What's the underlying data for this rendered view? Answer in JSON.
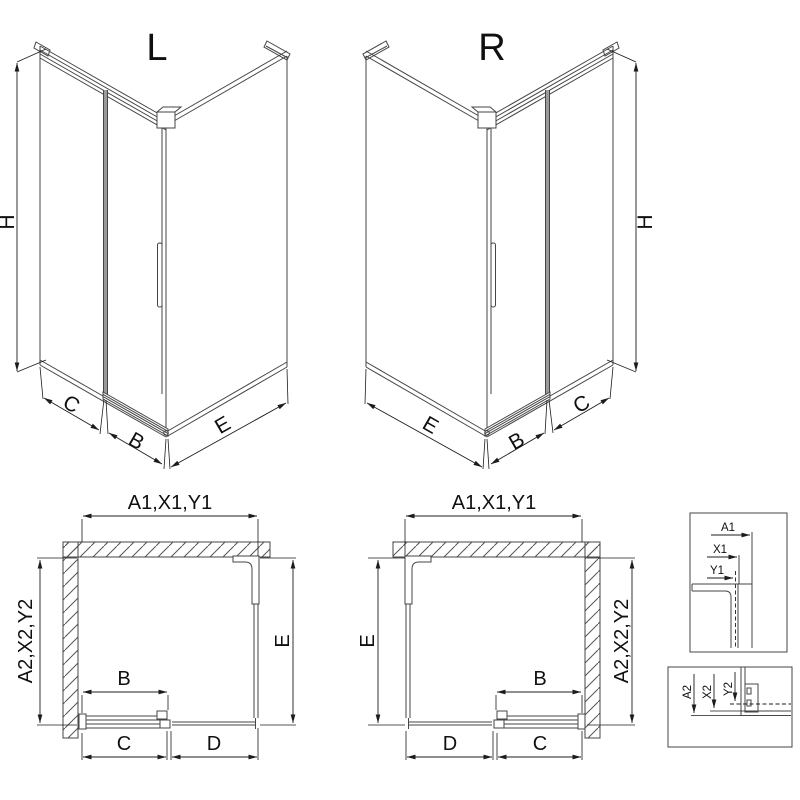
{
  "colors": {
    "line": "#454545",
    "dimension": "#1c1c1c",
    "text": "#101010",
    "door_seal": "#9a9a9a",
    "background": "#ffffff"
  },
  "iso_left": {
    "title": "L",
    "dims": {
      "height": "H",
      "fixed": "C",
      "door": "B",
      "side": "E"
    }
  },
  "iso_right": {
    "title": "R",
    "dims": {
      "height": "H",
      "side": "E",
      "door": "B",
      "fixed": "C"
    }
  },
  "plan_left": {
    "dims": {
      "width_top": "A1,X1,Y1",
      "depth_left": "A2,X2,Y2",
      "door_travel": "B",
      "side_depth": "E",
      "door_width": "C",
      "fixed_width": "D"
    }
  },
  "plan_right": {
    "dims": {
      "width_top": "A1,X1,Y1",
      "side_depth": "E",
      "depth_right": "A2,X2,Y2",
      "door_travel": "B",
      "fixed_width": "D",
      "door_width": "C"
    }
  },
  "detail_top": {
    "labels": [
      "A1",
      "X1",
      "Y1"
    ]
  },
  "detail_bottom": {
    "labels": [
      "A2",
      "X2",
      "Y2"
    ]
  }
}
